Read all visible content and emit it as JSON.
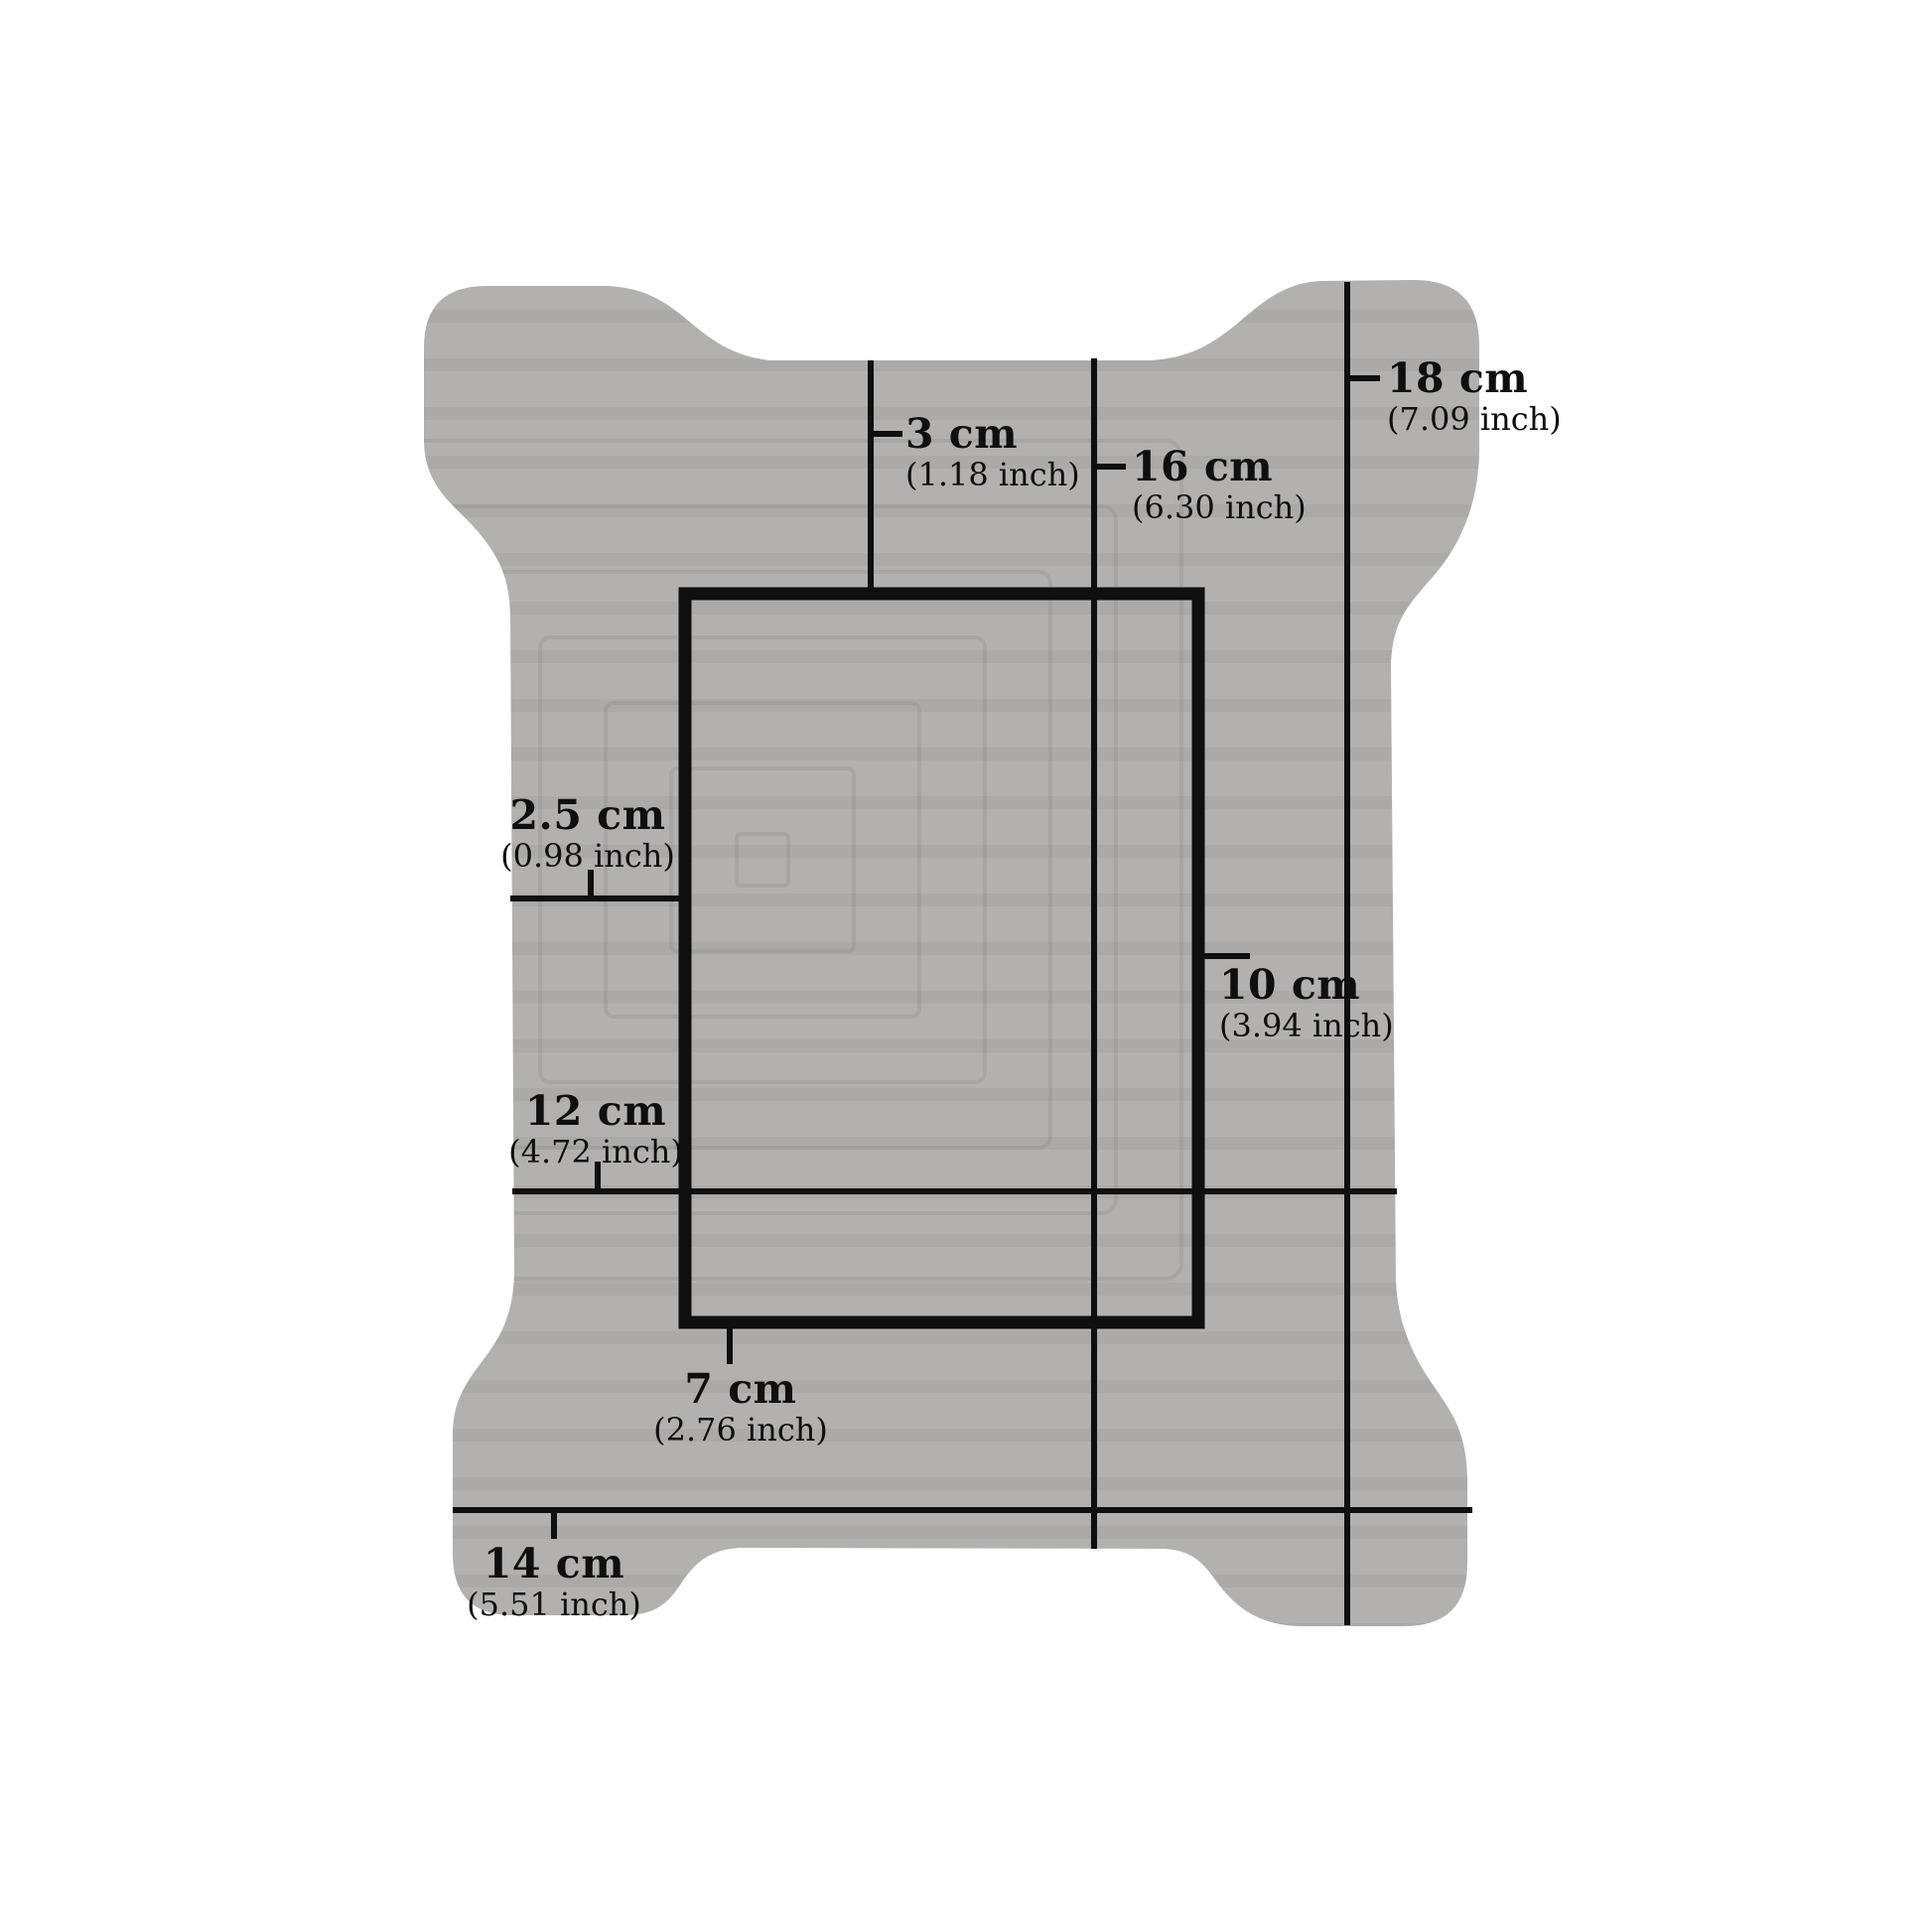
{
  "colors": {
    "background": "#ffffff",
    "board": "#b2b1b0",
    "board_stripe": "#9f9e9d",
    "ink": "#0f0f0f"
  },
  "measurements": {
    "top_margin": {
      "cm": "3 cm",
      "inch": "(1.18 inch)"
    },
    "body_height": {
      "cm": "16 cm",
      "inch": "(6.30 inch)"
    },
    "total_height": {
      "cm": "18 cm",
      "inch": "(7.09 inch)"
    },
    "left_margin": {
      "cm": "2.5 cm",
      "inch": "(0.98 inch)"
    },
    "window_height": {
      "cm": "10 cm",
      "inch": "(3.94 inch)"
    },
    "body_width": {
      "cm": "12 cm",
      "inch": "(4.72 inch)"
    },
    "window_width": {
      "cm": "7 cm",
      "inch": "(2.76 inch)"
    },
    "total_width": {
      "cm": "14 cm",
      "inch": "(5.51 inch)"
    }
  }
}
